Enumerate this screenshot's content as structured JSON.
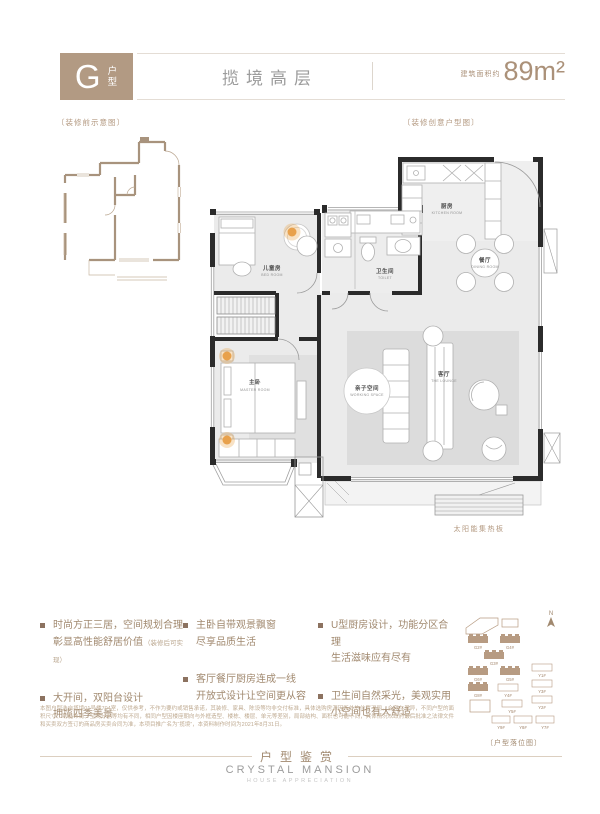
{
  "header": {
    "badge_letter": "G",
    "badge_type_top": "户",
    "badge_type_bottom": "型",
    "title": "揽境高层",
    "area_prefix": "建筑面积约",
    "area_value": "89m²"
  },
  "plan_small": {
    "label": "〔装修前示意图〕"
  },
  "plan_main": {
    "label": "〔装修创意户型图〕",
    "solar_label": "太阳能集热板",
    "rooms": {
      "kids": {
        "cn": "儿童房",
        "en": "BED ROOM"
      },
      "toilet": {
        "cn": "卫生间",
        "en": "TOILET"
      },
      "kitchen": {
        "cn": "厨房",
        "en": "KITCHEN ROOM"
      },
      "dining": {
        "cn": "餐厅",
        "en": "DINING ROOM"
      },
      "working": {
        "cn": "亲子空间",
        "en": "WORKING SPACE"
      },
      "lounge": {
        "cn": "客厅",
        "en": "THE LOUNGE"
      },
      "master": {
        "cn": "主卧",
        "en": "MASTER ROOM"
      }
    }
  },
  "features": {
    "columns": [
      {
        "items": [
          {
            "line1": "时尚方正三居，空间规划合理",
            "line2": "彰显高性能舒居价值",
            "note": "（装修后可实现）"
          },
          {
            "line1": "大开间，双阳台设计",
            "line2": "拥揽四季美景",
            "note": ""
          }
        ]
      },
      {
        "items": [
          {
            "line1": "主卧自带观景飘窗",
            "line2": "尽享品质生活",
            "note": ""
          },
          {
            "line1": "客厅餐厅厨房连成一线",
            "line2": "开放式设计让空间更从容",
            "note": ""
          }
        ]
      },
      {
        "items": [
          {
            "line1": "U型厨房设计，功能分区合理",
            "line2": "生活滋味应有尽有",
            "note": ""
          },
          {
            "line1": "卫生间自然采光，美观实用",
            "line2": "小空间也有大舒适",
            "note": ""
          }
        ]
      }
    ]
  },
  "sitemap": {
    "label": "〔户型落位图〕",
    "north_label": "N",
    "filled": [
      "G2#",
      "G4#",
      "G3#",
      "G6#",
      "G5#",
      "G8#"
    ],
    "outline": [
      "Y1#",
      "Y3#",
      "Y4#",
      "Y2#",
      "Y5#",
      "Y9#",
      "Y8#",
      "Y7#"
    ]
  },
  "disclaimer": "本图户型选自揽境01号楼704室，仅供参考，不作为要约或销售承诺，其装修、家具、陈设等均非交付标准，具体选购房源因所处的位置不同，会存在差异，不同户型的面积尺寸、功能布局、空间分割等均有不同，相同户型因楼座朝向与外框造型、楼栋、楼层、单元等差别，局部结构、面积也可能不同，具体情况以政府最后批准之法律文件和买卖双方签订的商品房买卖合同为准，本项目推广名为“揽境”，本资料制作时间为2021年8月31日。",
  "footer": {
    "title_cn": "户型鉴赏",
    "title_en": "CRYSTAL MANSION",
    "subtitle": "HOUSE APPRECIATION"
  }
}
